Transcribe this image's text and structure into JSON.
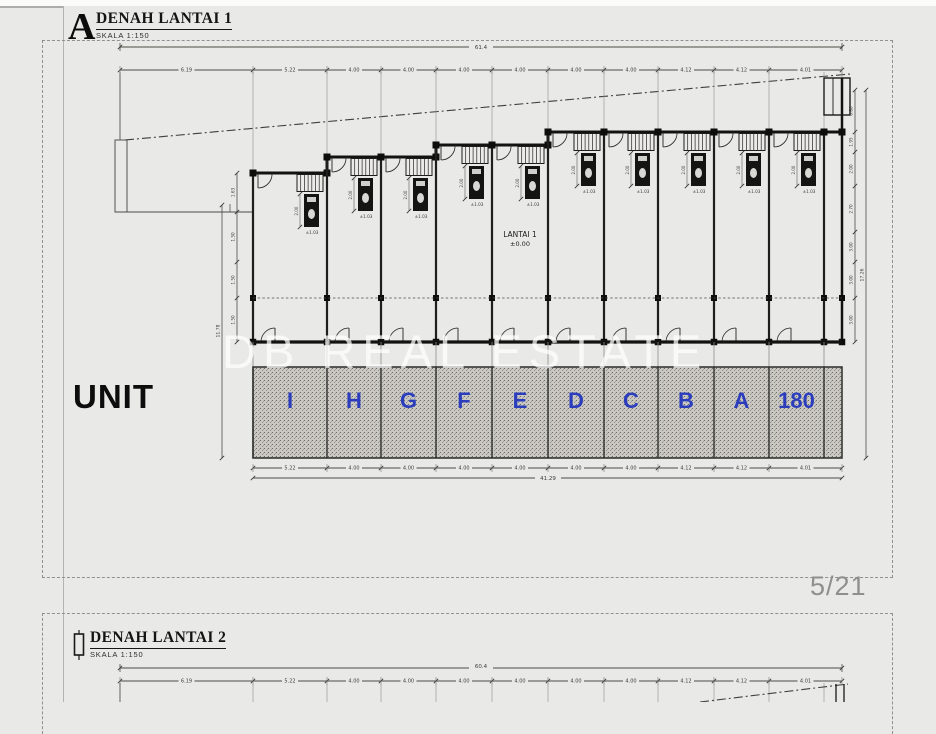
{
  "page": {
    "watermark": "DB REAL ESTATE",
    "page_indicator": "5/21",
    "unit_heading": "UNIT"
  },
  "sheet1": {
    "marker": "A",
    "title": "DENAH LANTAI 1",
    "scale": "SKALA 1:150"
  },
  "sheet2": {
    "title": "DENAH LANTAI 2",
    "scale": "SKALA 1:150"
  },
  "plan1": {
    "floor_label": "LANTAI 1",
    "floor_level": "±0.00",
    "unit_letters": [
      "I",
      "H",
      "G",
      "F",
      "E",
      "D",
      "C",
      "B",
      "A",
      "180"
    ],
    "unit_letter_color": "#2b3cbd",
    "top_overall": "61.4",
    "top_segments": [
      "6.19",
      "5.22",
      "4.00",
      "4.00",
      "4.00",
      "4.00",
      "4.00",
      "4.00",
      "4.12",
      "4.12",
      "4.01"
    ],
    "bottom_segments": [
      "5.22",
      "4.00",
      "4.00",
      "4.00",
      "4.00",
      "4.00",
      "4.00",
      "4.12",
      "4.12",
      "4.01"
    ],
    "bottom_overall": "41.29",
    "right_segments": [
      "0.80",
      "1.95",
      "2.00",
      "2.70",
      "3.00",
      "3.00",
      "3.00"
    ],
    "right_overall": "17.26",
    "left_segments": [
      "1.63",
      "1.50",
      "1.50",
      "1.50"
    ],
    "left_outer": "11.78",
    "toilet_level": "±1.03",
    "toilet_dim": "2.00"
  },
  "plan2": {
    "top_overall": "60.4",
    "top_segments": [
      "6.19",
      "5.22",
      "4.00",
      "4.00",
      "4.00",
      "4.00",
      "4.00",
      "4.00",
      "4.12",
      "4.12",
      "4.01"
    ]
  }
}
